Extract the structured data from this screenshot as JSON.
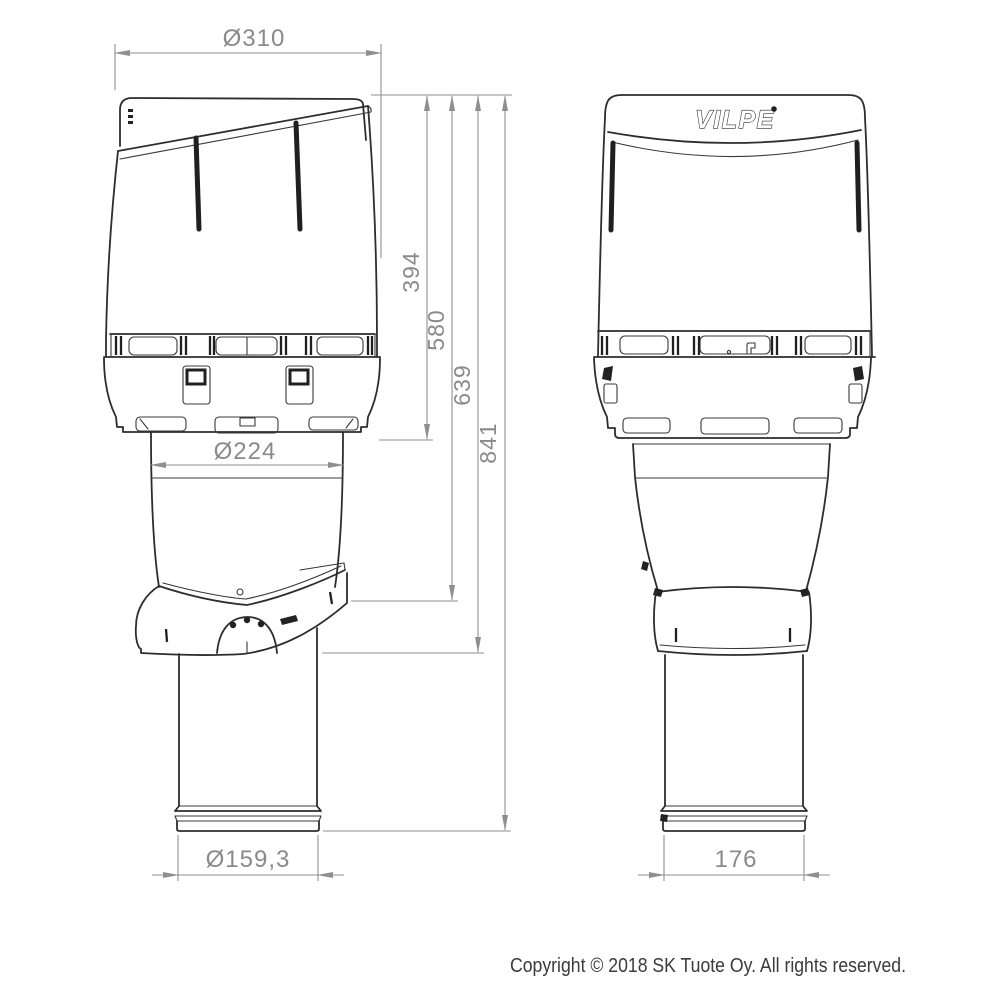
{
  "logo": {
    "text": "VILPE"
  },
  "labels": {
    "dia_310": "Ø310",
    "dia_224": "Ø224",
    "dia_159_3": "Ø159,3",
    "w_176": "176",
    "h_394": "394",
    "h_580": "580",
    "h_639": "639",
    "h_841": "841"
  },
  "footer": {
    "copyright": "Copyright © 2018 SK Tuote Oy. All rights reserved."
  }
}
